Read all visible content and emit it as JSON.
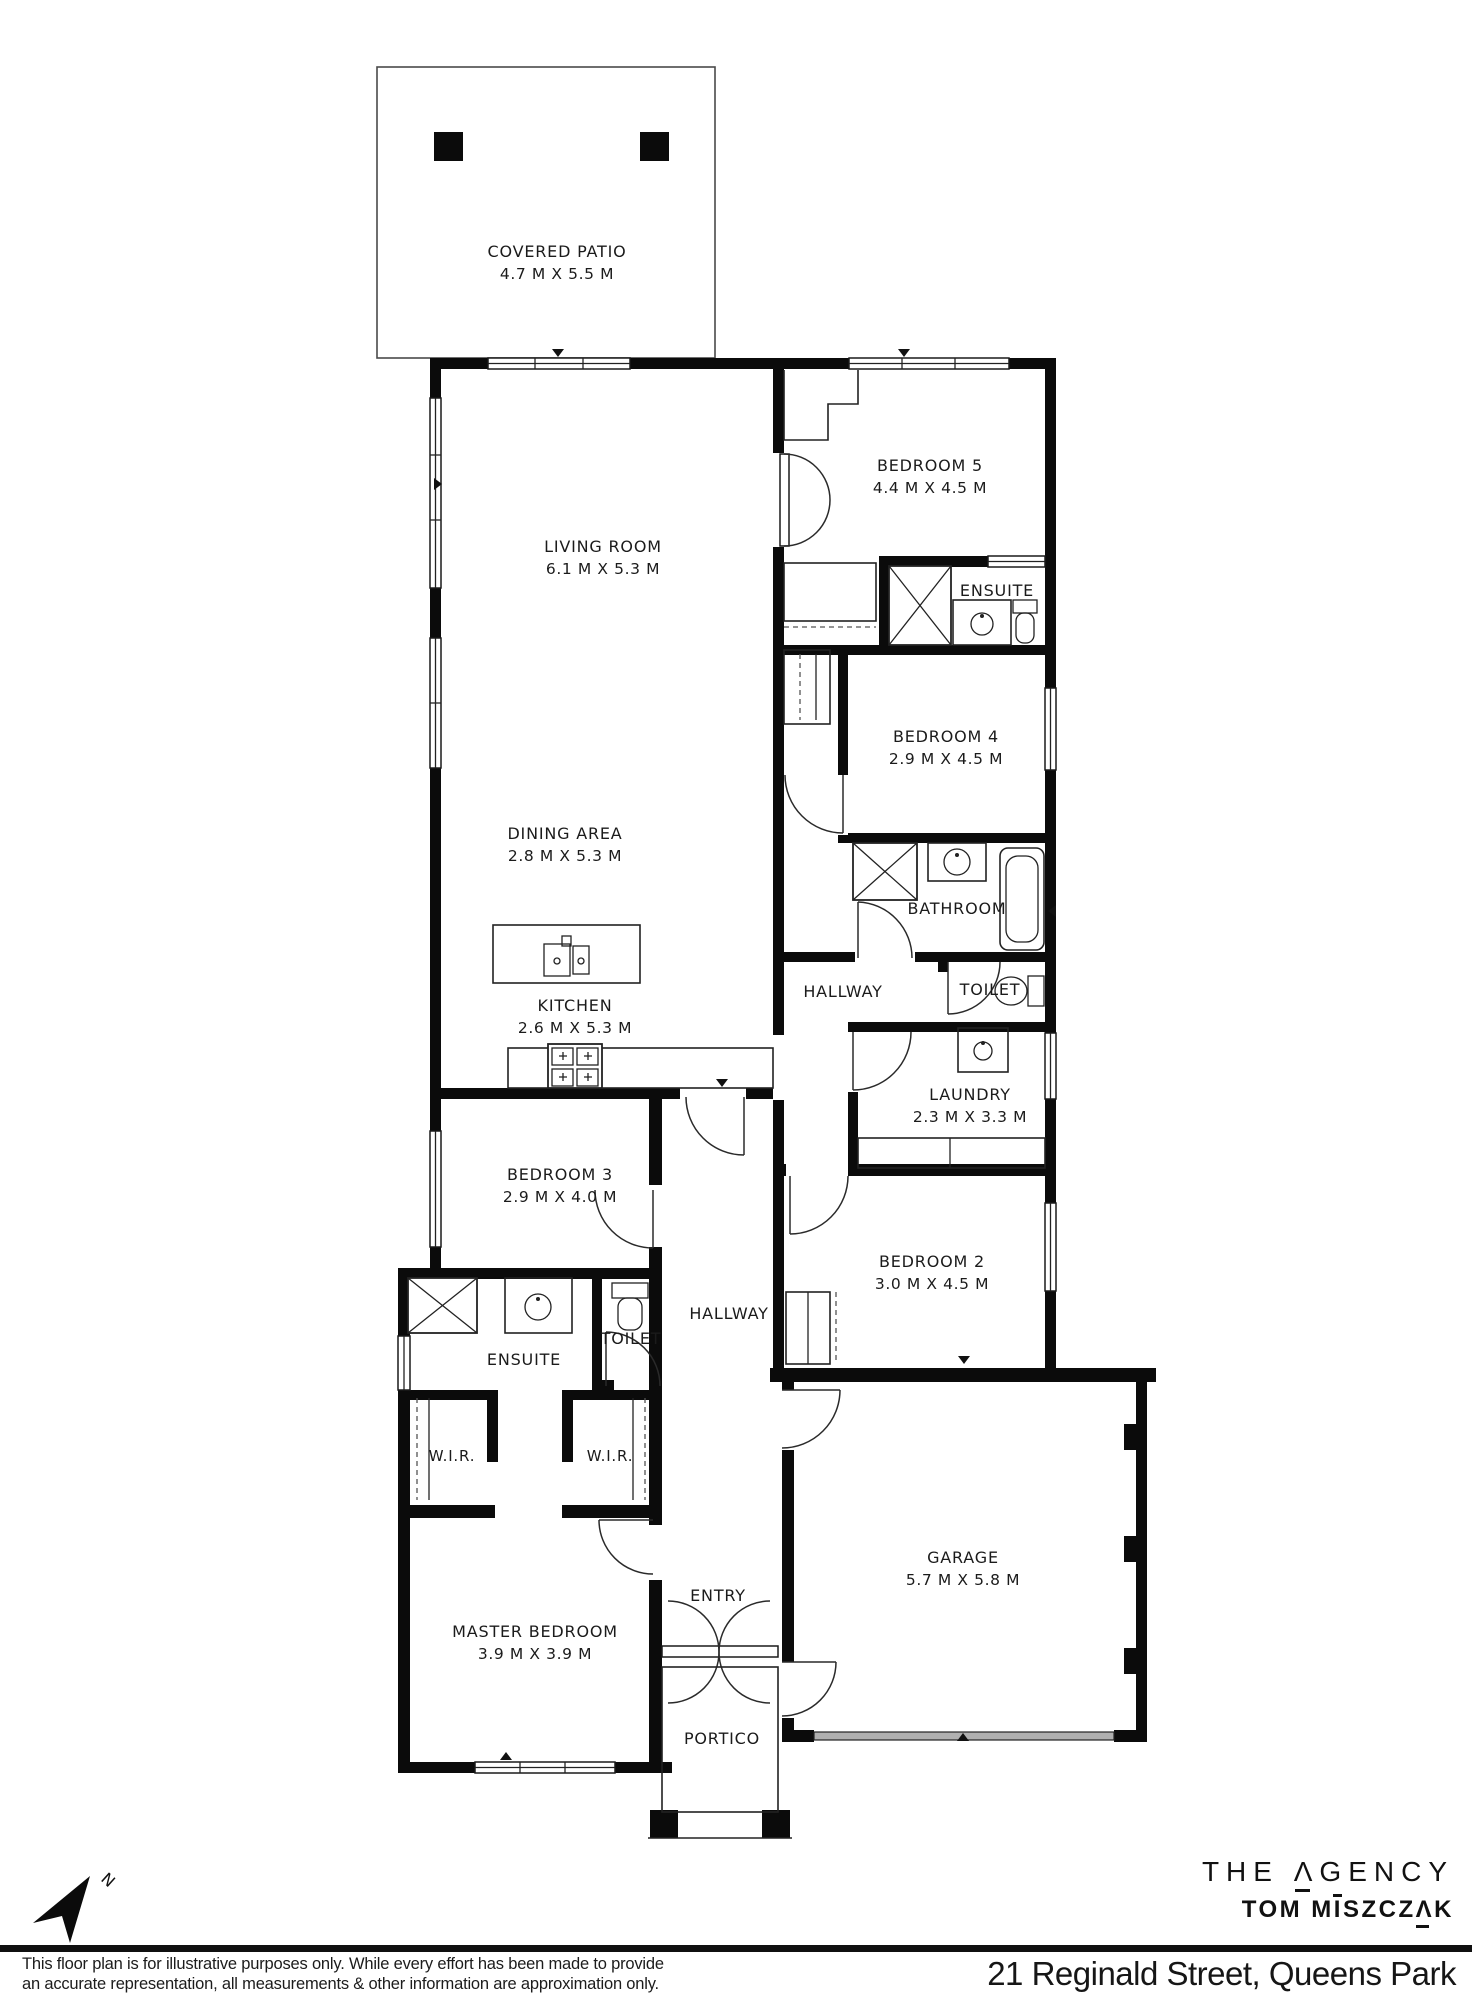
{
  "rooms": {
    "covered_patio": {
      "name": "COVERED PATIO",
      "dims": "4.7 M X 5.5 M"
    },
    "living": {
      "name": "LIVING ROOM",
      "dims": "6.1 M X 5.3 M"
    },
    "bedroom5": {
      "name": "BEDROOM 5",
      "dims": "4.4 M X 4.5 M"
    },
    "ensuite5": {
      "name": "ENSUITE"
    },
    "bedroom4": {
      "name": "BEDROOM 4",
      "dims": "2.9 M X 4.5 M"
    },
    "dining": {
      "name": "DINING AREA",
      "dims": "2.8 M X 5.3 M"
    },
    "bathroom": {
      "name": "BATHROOM"
    },
    "hallway_upper": {
      "name": "HALLWAY"
    },
    "toilet_upper": {
      "name": "TOILET"
    },
    "kitchen": {
      "name": "KITCHEN",
      "dims": "2.6 M X 5.3 M"
    },
    "laundry": {
      "name": "LAUNDRY",
      "dims": "2.3 M X 3.3 M"
    },
    "bedroom3": {
      "name": "BEDROOM 3",
      "dims": "2.9 M X 4.0 M"
    },
    "bedroom2": {
      "name": "BEDROOM 2",
      "dims": "3.0 M X 4.5 M"
    },
    "ensuite_master": {
      "name": "ENSUITE"
    },
    "toilet_mid": {
      "name": "TOILET"
    },
    "hallway_lower": {
      "name": "HALLWAY"
    },
    "wir_left": {
      "name": "W.I.R."
    },
    "wir_right": {
      "name": "W.I.R."
    },
    "master": {
      "name": "MASTER BEDROOM",
      "dims": "3.9 M X 3.9 M"
    },
    "entry": {
      "name": "ENTRY"
    },
    "garage": {
      "name": "GARAGE",
      "dims": "5.7 M X 5.8 M"
    },
    "portico": {
      "name": "PORTICO"
    }
  },
  "compass": {
    "north_label": "N"
  },
  "brand": {
    "line1_pre": "THE ",
    "line1_a": "Λ",
    "line1_post": "GENCY",
    "line2_pre": "TOM M",
    "line2_i": "I",
    "line2_mid": "SZCZ",
    "line2_a": "Λ",
    "line2_post": "K"
  },
  "footer": {
    "disclaimer_line1": "This floor plan is for illustrative purposes only. While every effort has been made to provide",
    "disclaimer_line2": "an accurate representation, all measurements & other information are approximation only.",
    "address": "21 Reginald Street, Queens Park"
  },
  "colors": {
    "wall": "#0b0b0b",
    "line": "#222222",
    "text": "#1b1b1b",
    "garage_door": "#b0b0b0"
  }
}
